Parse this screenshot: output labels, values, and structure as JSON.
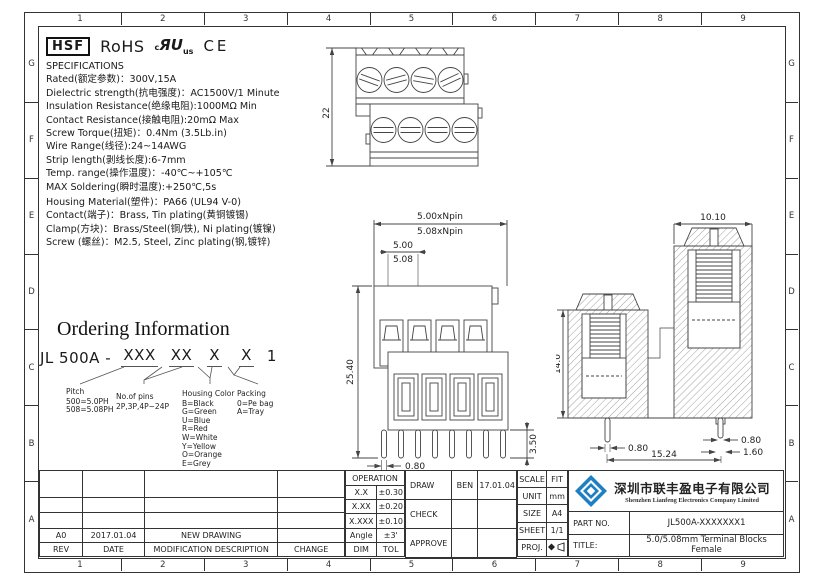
{
  "zones": {
    "cols": [
      "1",
      "2",
      "3",
      "4",
      "5",
      "6",
      "7",
      "8",
      "9"
    ],
    "rows": [
      "G",
      "F",
      "E",
      "D",
      "C",
      "B",
      "A"
    ]
  },
  "certs": {
    "hsf": "HSF",
    "rohs": "RoHS",
    "ul_c": "c",
    "ul_mark": "ЯU",
    "ul_us": "us",
    "ce": "CE"
  },
  "specs": {
    "title": "SPECIFICATIONS",
    "lines": [
      "Rated(额定参数)：300V,15A",
      "Dielectric strength(抗电强度)：AC1500V/1 Minute",
      "Insulation Resistance(绝缘电阻):1000MΩ Min",
      "Contact Resistance(接触电阻):20mΩ Max",
      "Screw Torque(扭矩)：0.4Nm (3.5Lb.in)",
      "Wire Range(线径):24~14AWG",
      "Strip length(剥线长度):6-7mm",
      "Temp. range(操作温度)：-40℃~+105℃",
      "MAX Soldering(瞬时温度):+250℃,5s"
    ]
  },
  "materials": {
    "lines": [
      "Housing Material(塑件)：PA66 (UL94 V-0)",
      "Contact(端子)：Brass, Tin plating(黄铜镀锡)",
      "Clamp(方块)：Brass/Steel(铜/铁), Ni plating(镀镍)",
      "Screw (螺丝)：M2.5, Steel, Zinc plating(钢,镀锌)"
    ]
  },
  "ordering": {
    "title": "Ordering Information",
    "code_prefix": "JL 500A - ",
    "code_groups": [
      "XXX",
      "XX",
      "X",
      "X"
    ],
    "code_suffix": "1",
    "legend": [
      {
        "title": "Pitch",
        "lines": [
          "500=5.0PH",
          "508=5.08PH"
        ]
      },
      {
        "title": "No.of pins",
        "lines": [
          "2P,3P,4P~24P"
        ]
      },
      {
        "title": "Housing Color",
        "lines": [
          "B=Black",
          "G=Green",
          "U=Blue",
          "R=Red",
          "W=White",
          "Y=Yellow",
          "O=Orange",
          "E=Grey"
        ]
      },
      {
        "title": "Packing",
        "lines": [
          "0=Pe bag",
          "A=Tray"
        ]
      }
    ]
  },
  "drawings": {
    "top_view": {
      "dim_height": "22"
    },
    "front_view": {
      "dim_total_1": "5.00xNpin",
      "dim_total_2": "5.08xNpin",
      "dim_pitch_1": "5.00",
      "dim_pitch_2": "5.08",
      "dim_height": "25.40",
      "dim_pin_len": "3.50",
      "dim_pin_w": "0.80"
    },
    "side_view": {
      "dim_width": "10.10",
      "dim_height": "14.0",
      "dim_pin_left": "0.80",
      "dim_pin_right": "0.80",
      "dim_pin_right2": "1.60",
      "dim_span": "15.24"
    }
  },
  "revision_table": {
    "headers": [
      "REV",
      "DATE",
      "MODIFICATION DESCRIPTION",
      "CHANGE"
    ],
    "rows": [
      {
        "rev": "A0",
        "date": "2017.01.04",
        "desc": "NEW DRAWING",
        "change": ""
      }
    ]
  },
  "tolerance_table": {
    "header": "OPERATION",
    "rows": [
      [
        "X.X",
        "±0.30"
      ],
      [
        "X.XX",
        "±0.20"
      ],
      [
        "X.XXX",
        "±0.10"
      ],
      [
        "Angle",
        "±3'"
      ],
      [
        "DIM",
        "TOL"
      ]
    ]
  },
  "approval": {
    "rows": [
      {
        "label": "DRAW",
        "name": "BEN",
        "date": "17.01.04"
      },
      {
        "label": "CHECK",
        "name": "",
        "date": ""
      },
      {
        "label": "APPROVE",
        "name": "",
        "date": ""
      }
    ]
  },
  "info": {
    "rows": [
      [
        "SCALE",
        "FIT"
      ],
      [
        "UNIT",
        "mm"
      ],
      [
        "SIZE",
        "A4"
      ],
      [
        "SHEET",
        "1/1"
      ]
    ],
    "proj_label": "PROJ."
  },
  "company": {
    "name_cn": "深圳市联丰盈电子有限公司",
    "name_en": "Shenzhen Lianfeng Electronics Company Limited",
    "part_label": "PART NO.",
    "part_no": "JL500A-XXXXXXX1",
    "title_label": "TITLE:",
    "title": "5.0/5.08mm Terminal Blocks Female",
    "logo_color": "#1d7fc4"
  }
}
